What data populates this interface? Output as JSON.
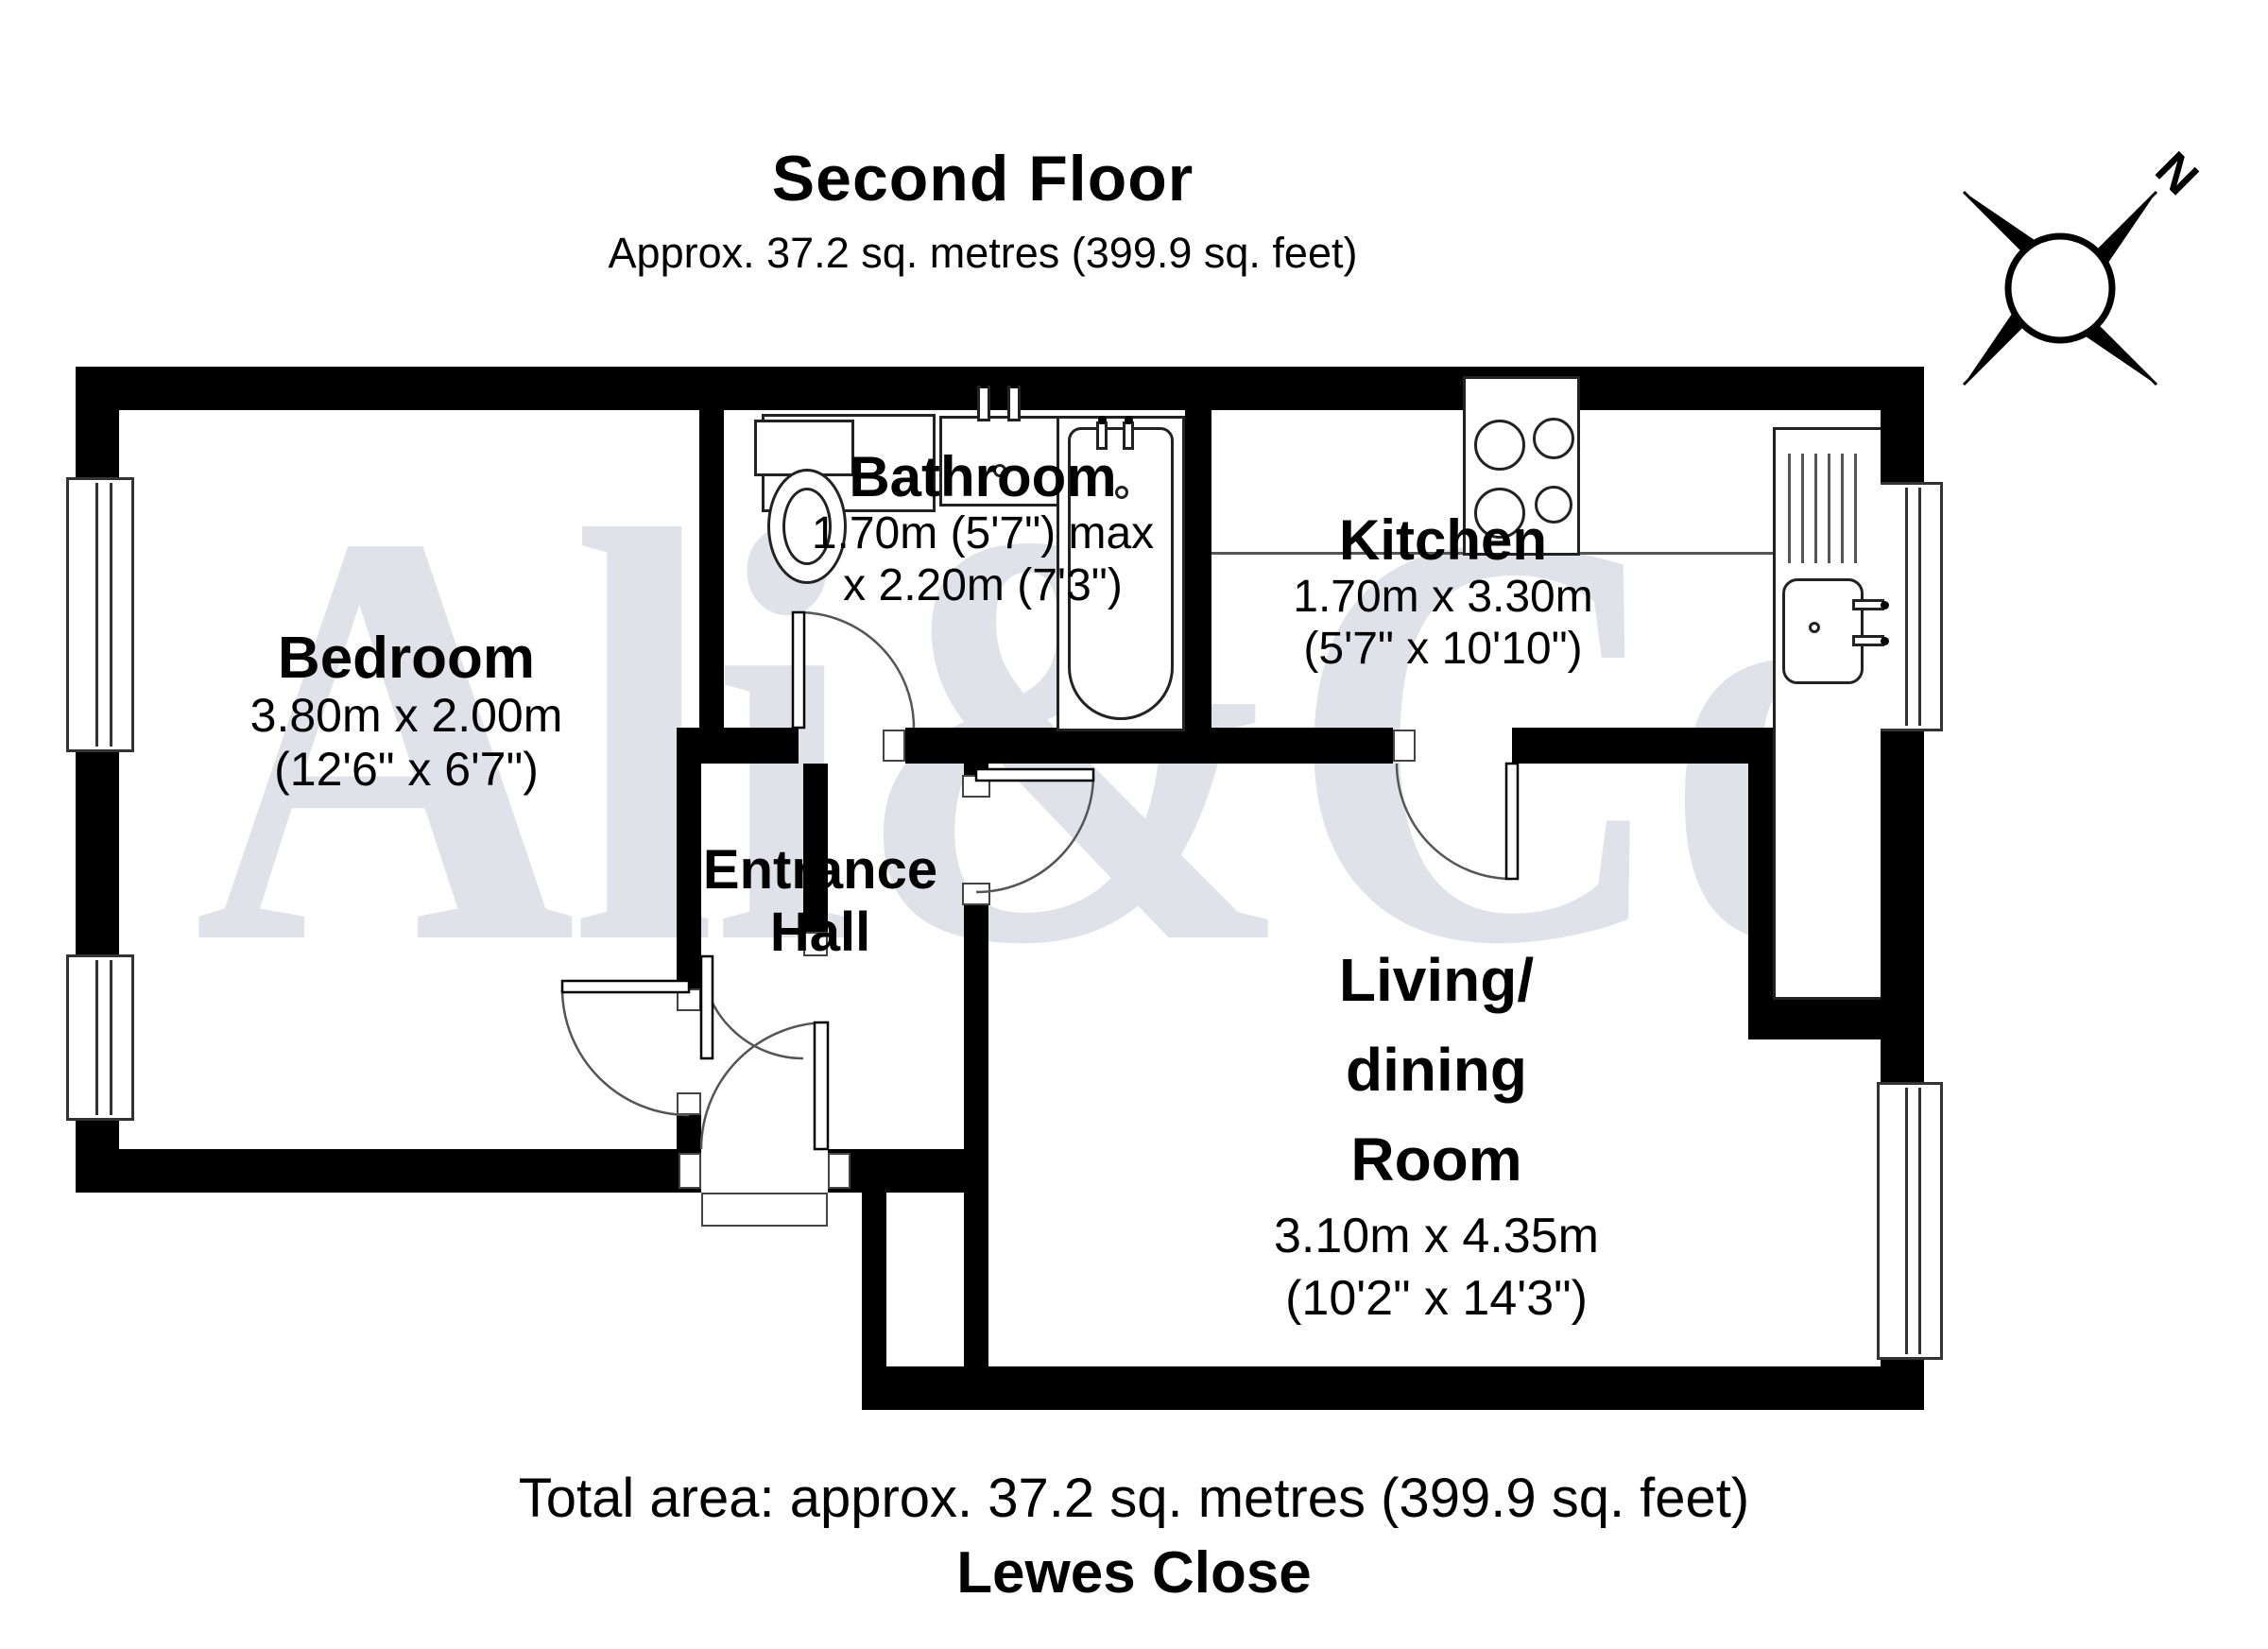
{
  "header": {
    "title": "Second Floor",
    "subtitle": "Approx. 37.2 sq. metres (399.9 sq. feet)"
  },
  "watermark": {
    "text": "Ali&Co"
  },
  "compass": {
    "label": "N"
  },
  "rooms": {
    "bedroom": {
      "name": "Bedroom",
      "dim_metric": "3.80m x 2.00m",
      "dim_imperial": "(12'6\" x 6'7\")"
    },
    "bathroom": {
      "name": "Bathroom",
      "dim_metric": "1.70m (5'7\") max",
      "dim_imperial": "x 2.20m (7'3\")"
    },
    "kitchen": {
      "name": "Kitchen",
      "dim_metric": "1.70m x 3.30m",
      "dim_imperial": "(5'7\" x 10'10\")"
    },
    "hall": {
      "line1": "Entrance",
      "line2": "Hall"
    },
    "living": {
      "line1": "Living/",
      "line2": "dining",
      "line3": "Room",
      "dim_metric": "3.10m x 4.35m",
      "dim_imperial": "(10'2\" x 14'3\")"
    }
  },
  "footer": {
    "total_area": "Total area: approx. 37.2 sq. metres (399.9 sq. feet)",
    "address": "Lewes Close"
  },
  "colors": {
    "wall": "#000000",
    "floor": "#ffffff",
    "watermark": "#ccd2dd"
  }
}
